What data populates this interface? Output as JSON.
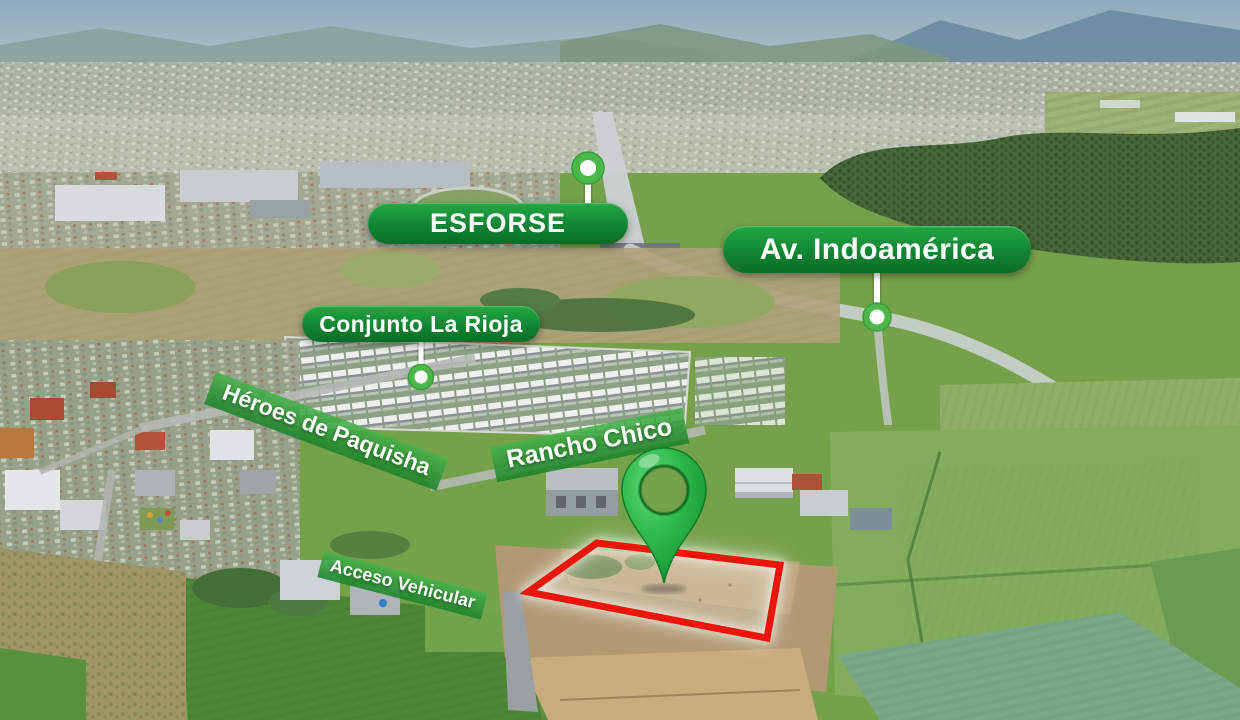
{
  "colors": {
    "badge_green_top": "#24a844",
    "badge_green_bottom": "#0a6c26",
    "street_band_green": "rgba(44,158,60,0.88)",
    "pin_green": "#2fbe49",
    "plot_outline_red": "#ee1409"
  },
  "badges": [
    {
      "id": "esforse",
      "label": "ESFORSE",
      "marker_position": "above"
    },
    {
      "id": "av_indoamerica",
      "label": "Av. Indoamérica",
      "marker_position": "below"
    },
    {
      "id": "conjunto_la_rioja",
      "label": "Conjunto La Rioja",
      "marker_position": "below"
    }
  ],
  "street_labels": [
    {
      "id": "heroes_de_paquisha",
      "label": "Héroes de Paquisha"
    },
    {
      "id": "rancho_chico",
      "label": "Rancho Chico"
    },
    {
      "id": "acceso_vehicular",
      "label": "Acceso Vehicular"
    }
  ],
  "icons": {
    "pin": "location-pin-icon",
    "marker_dot": "marker-dot-icon"
  }
}
